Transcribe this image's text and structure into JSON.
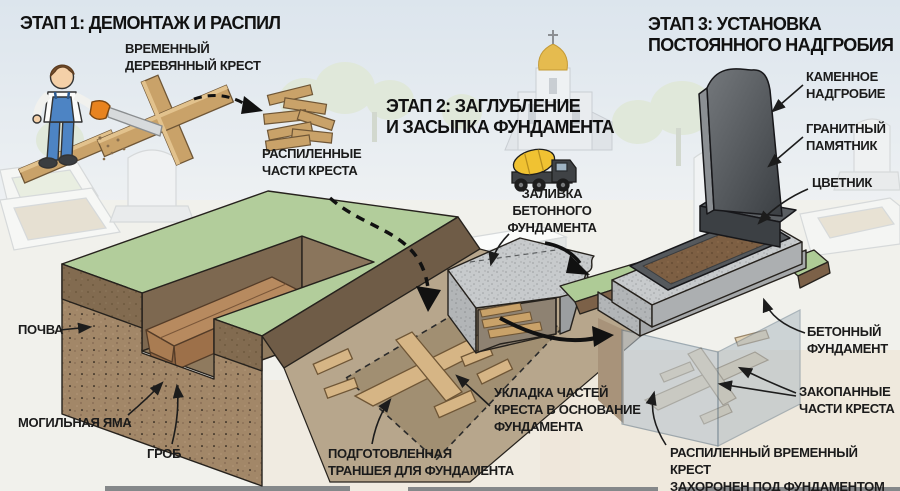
{
  "stage1": {
    "title": "ЭТАП 1: ДЕМОНТАЖ И РАСПИЛ",
    "labels": {
      "temporary_cross": "ВРЕМЕННЫЙ\nДЕРЕВЯННЫЙ КРЕСТ",
      "sawn_parts": "РАСПИЛЕННЫЕ\nЧАСТИ КРЕСТА"
    }
  },
  "stage2": {
    "title": "ЭТАП 2: ЗАГЛУБЛЕНИЕ\nИ ЗАСЫПКА ФУНДАМЕНТА",
    "labels": {
      "concrete_pour": "ЗАЛИВКА\nБЕТОННОГО\nФУНДАМЕНТА",
      "soil": "ПОЧВА",
      "grave_pit": "МОГИЛЬНАЯ ЯМА",
      "coffin": "ГРОБ",
      "trench": "ПОДГОТОВЛЕННАЯ\nТРАНШЕЯ ДЛЯ ФУНДАМЕНТА",
      "laying": "УКЛАДКА ЧАСТЕЙ\nКРЕСТА В ОСНОВАНИЕ\nФУНДАМЕНТА"
    }
  },
  "stage3": {
    "title": "ЭТАП 3: УСТАНОВКА\nПОСТОЯННОГО НАДГРОБИЯ",
    "labels": {
      "stone_tombstone": "КАМЕННОЕ\nНАДГРОБИЕ",
      "granite_monument": "ГРАНИТНЫЙ\nПАМЯТНИК",
      "flower_bed": "ЦВЕТНИК",
      "foundation": "БЕТОННЫЙ\nФУНДАМЕНТ",
      "buried_parts": "ЗАКОПАННЫЕ\nЧАСТИ КРЕСТА",
      "buried_note": "РАСПИЛЕННЫЙ ВРЕМЕННЫЙ КРЕСТ\nЗАХОРОНЕН ПОД ФУНДАМЕНТОМ"
    }
  },
  "icons": {
    "worker": "person-sawing-cross",
    "saw": "hand-saw",
    "cement_truck": "concrete-mixer-truck",
    "church": "orthodox-church-with-dome",
    "arrows": "dashed-and-solid-flow-arrows"
  },
  "colors": {
    "sky": "#dfe7ee",
    "ground": "#f1f1ec",
    "grass": "#b2cd9b",
    "soil_light": "#a08465",
    "soil_dark": "#80694f",
    "wood": "#c9a269",
    "wood_light": "#d6b585",
    "concrete": "#c6c9cb",
    "monument_dark": "#45494d",
    "truck_drum_yellow": "#f0c232",
    "church_dome_gold": "#e5bb4f",
    "text": "#1b1b1b"
  }
}
